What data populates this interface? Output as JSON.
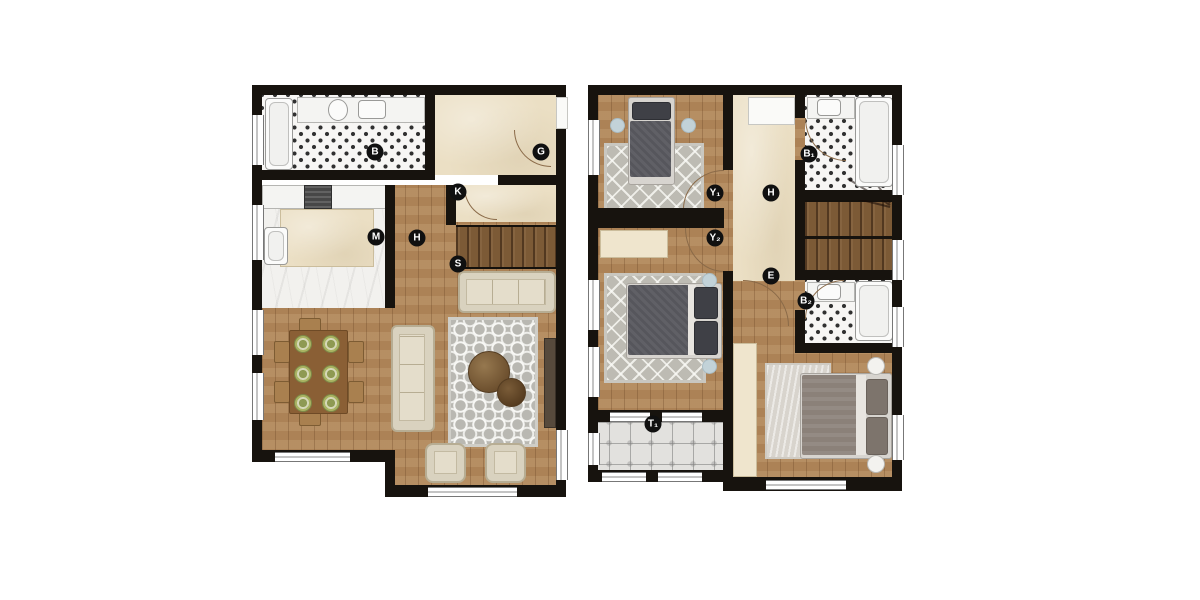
{
  "plans": {
    "ground": {
      "id": "ground-floor-plan",
      "labels": {
        "b": "B",
        "g": "G",
        "k": "K",
        "m": "M",
        "h": "H",
        "s": "S"
      }
    },
    "upper": {
      "id": "upper-floor-plan",
      "labels": {
        "y1": "Y₁",
        "h": "H",
        "b1": "B₁",
        "y2": "Y₂",
        "e": "E",
        "b2": "B₂",
        "t1": "T₁"
      }
    }
  },
  "colors": {
    "wall": "#17130e",
    "wood_floor": "#b1875a",
    "stair_wood": "#7c5a36",
    "cream_floor": "#ebdfc4",
    "marble_floor": "#f2f1ee",
    "bw_tile_accent": "#303030",
    "terrace_tile": "#e2e1de",
    "rug_grey": "#b9b8b2",
    "label_bg": "#101010",
    "label_text": "#ffffff"
  }
}
